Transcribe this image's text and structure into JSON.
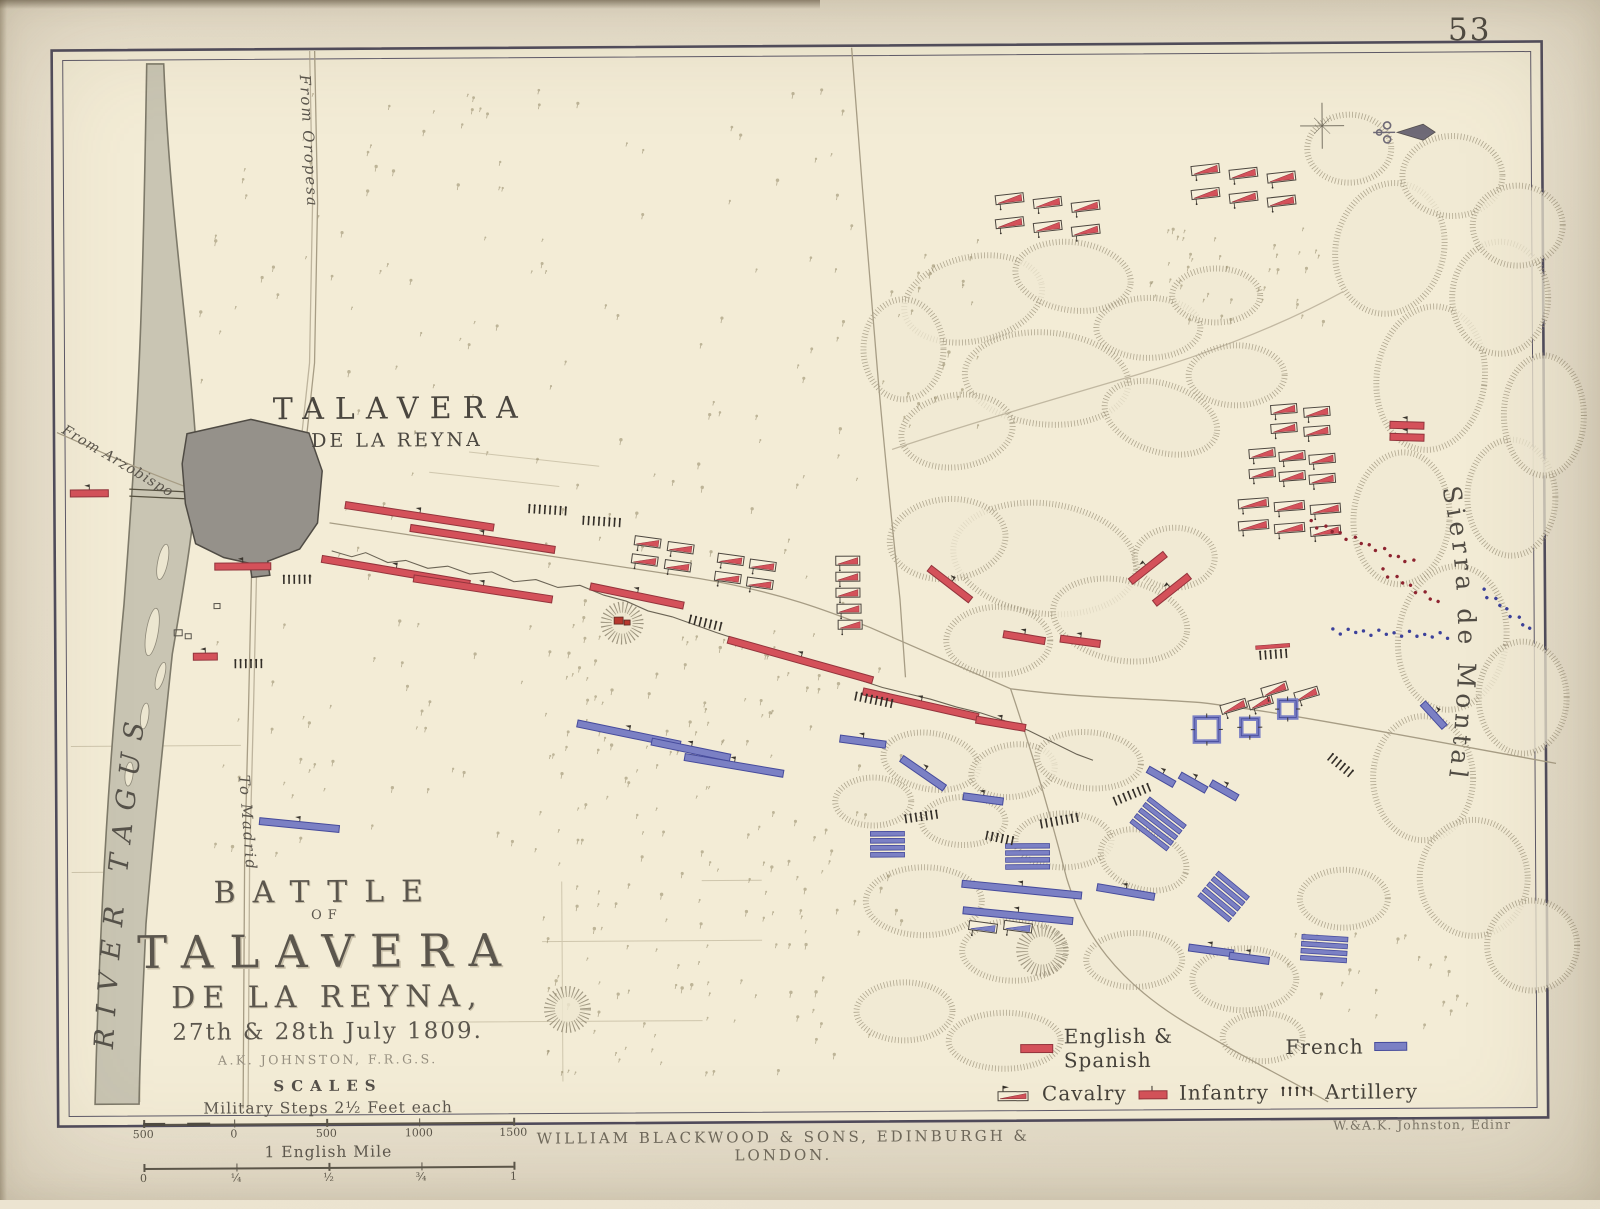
{
  "page": {
    "number": "53",
    "imprint": "WILLIAM BLACKWOOD & SONS, EDINBURGH & LONDON.",
    "engraver": "W.&A.K. Johnston, Edinr"
  },
  "title_block": {
    "line1": "BATTLE",
    "line2": "OF",
    "line3": "TALAVERA",
    "line4": "DE LA REYNA,",
    "line5": "27th & 28th July 1809.",
    "author": "A.K. JOHNSTON, F.R.G.S.",
    "scales_heading": "SCALES",
    "scale1_label": "Military Steps 2½ Feet each",
    "scale1_ticks": [
      "500",
      "0",
      "500",
      "1000",
      "1500"
    ],
    "scale2_label": "1 English Mile",
    "scale2_ticks": [
      "0",
      "¼",
      "½",
      "¾",
      "1"
    ]
  },
  "labels": {
    "town_line1": "TALAVERA",
    "town_line2": "DE LA REYNA",
    "river": "RIVER   TAGUS",
    "sierra": "Sierra de Montalban",
    "road_oropesa": "From Oropesa",
    "road_arzobispo": "From Arzobispo",
    "road_madrid": "To Madrid"
  },
  "legend": {
    "english": "English & Spanish",
    "french": "French",
    "cavalry": "Cavalry",
    "infantry": "Infantry",
    "artillery": "Artillery"
  },
  "colors": {
    "allied": "#d4515a",
    "allied_dark": "#93343c",
    "french": "#7b80c4",
    "french_dark": "#464b9c",
    "ink": "#332e28",
    "paper": "#f3ecd6",
    "frame": "#4f4b5c"
  },
  "units": [
    {
      "t": "inf",
      "s": "r",
      "x": 90,
      "y": 489,
      "w": 38,
      "a": 0
    },
    {
      "t": "inf",
      "s": "r",
      "x": 243,
      "y": 563,
      "w": 56,
      "a": 0
    },
    {
      "t": "inf",
      "s": "r",
      "x": 205,
      "y": 653,
      "w": 24,
      "a": 0
    },
    {
      "t": "inf",
      "s": "r",
      "x": 420,
      "y": 514,
      "w": 150,
      "a": 9
    },
    {
      "t": "inf",
      "s": "r",
      "x": 483,
      "y": 537,
      "w": 146,
      "a": 9
    },
    {
      "t": "inf",
      "s": "r",
      "x": 396,
      "y": 569,
      "w": 150,
      "a": 10
    },
    {
      "t": "inf",
      "s": "r",
      "x": 483,
      "y": 587,
      "w": 140,
      "a": 9
    },
    {
      "t": "inf",
      "s": "r",
      "x": 637,
      "y": 595,
      "w": 95,
      "a": 12
    },
    {
      "t": "inf",
      "s": "r",
      "x": 800,
      "y": 660,
      "w": 150,
      "a": 16
    },
    {
      "t": "inf",
      "s": "r",
      "x": 920,
      "y": 705,
      "w": 118,
      "a": 13
    },
    {
      "t": "inf",
      "s": "r",
      "x": 1000,
      "y": 725,
      "w": 50,
      "a": 10
    },
    {
      "t": "inf",
      "s": "r",
      "x": 950,
      "y": 585,
      "w": 52,
      "a": 38
    },
    {
      "t": "inf",
      "s": "r",
      "x": 1024,
      "y": 639,
      "w": 42,
      "a": 10
    },
    {
      "t": "inf",
      "s": "r",
      "x": 1080,
      "y": 643,
      "w": 40,
      "a": 8
    },
    {
      "t": "inf",
      "s": "r",
      "x": 1148,
      "y": 570,
      "w": 44,
      "a": -38
    },
    {
      "t": "inf",
      "s": "r",
      "x": 1172,
      "y": 592,
      "w": 44,
      "a": -38
    },
    {
      "t": "inf",
      "s": "r",
      "x": 1408,
      "y": 429,
      "w": 34,
      "a": 2
    },
    {
      "t": "inf",
      "s": "r",
      "x": 1408,
      "y": 441,
      "w": 34,
      "a": 2
    },
    {
      "t": "art",
      "s": "r",
      "x": 297,
      "y": 577,
      "n": 6,
      "a": 0
    },
    {
      "t": "art",
      "s": "r",
      "x": 248,
      "y": 661,
      "n": 6,
      "a": 0
    },
    {
      "t": "art",
      "s": "r",
      "x": 705,
      "y": 623,
      "n": 7,
      "a": 14
    },
    {
      "t": "art",
      "s": "r",
      "x": 873,
      "y": 701,
      "n": 8,
      "a": 12
    },
    {
      "t": "art",
      "s": "r",
      "x": 1273,
      "y": 658,
      "n": 6,
      "a": -4,
      "bar": true
    },
    {
      "t": "art",
      "s": "k",
      "x": 548,
      "y": 509,
      "n": 8,
      "a": 4
    },
    {
      "t": "art",
      "s": "k",
      "x": 602,
      "y": 521,
      "n": 8,
      "a": 4
    },
    {
      "t": "cav",
      "s": "r",
      "x": 648,
      "y": 541,
      "w": 26,
      "a": 8
    },
    {
      "t": "cav",
      "s": "r",
      "x": 681,
      "y": 547,
      "w": 26,
      "a": 8
    },
    {
      "t": "cav",
      "s": "r",
      "x": 645,
      "y": 559,
      "w": 26,
      "a": 8
    },
    {
      "t": "cav",
      "s": "r",
      "x": 678,
      "y": 565,
      "w": 26,
      "a": 8
    },
    {
      "t": "cav",
      "s": "r",
      "x": 731,
      "y": 559,
      "w": 26,
      "a": 8
    },
    {
      "t": "cav",
      "s": "r",
      "x": 763,
      "y": 565,
      "w": 26,
      "a": 8
    },
    {
      "t": "cav",
      "s": "r",
      "x": 728,
      "y": 577,
      "w": 26,
      "a": 8
    },
    {
      "t": "cav",
      "s": "r",
      "x": 760,
      "y": 583,
      "w": 26,
      "a": 8
    },
    {
      "t": "cav",
      "s": "r",
      "x": 848,
      "y": 561,
      "w": 24,
      "a": 0
    },
    {
      "t": "cav",
      "s": "r",
      "x": 848,
      "y": 577,
      "w": 24,
      "a": 0
    },
    {
      "t": "cav",
      "s": "r",
      "x": 848,
      "y": 593,
      "w": 24,
      "a": 0
    },
    {
      "t": "cav",
      "s": "r",
      "x": 849,
      "y": 609,
      "w": 24,
      "a": 0
    },
    {
      "t": "cav",
      "s": "r",
      "x": 850,
      "y": 625,
      "w": 24,
      "a": 0
    },
    {
      "t": "cav",
      "s": "r",
      "x": 1012,
      "y": 200,
      "w": 28,
      "a": -6
    },
    {
      "t": "cav",
      "s": "r",
      "x": 1050,
      "y": 204,
      "w": 28,
      "a": -6
    },
    {
      "t": "cav",
      "s": "r",
      "x": 1088,
      "y": 208,
      "w": 28,
      "a": -6
    },
    {
      "t": "cav",
      "s": "r",
      "x": 1012,
      "y": 224,
      "w": 28,
      "a": -6
    },
    {
      "t": "cav",
      "s": "r",
      "x": 1050,
      "y": 228,
      "w": 28,
      "a": -6
    },
    {
      "t": "cav",
      "s": "r",
      "x": 1088,
      "y": 232,
      "w": 28,
      "a": -6
    },
    {
      "t": "cav",
      "s": "r",
      "x": 1208,
      "y": 172,
      "w": 28,
      "a": -6
    },
    {
      "t": "cav",
      "s": "r",
      "x": 1246,
      "y": 176,
      "w": 28,
      "a": -6
    },
    {
      "t": "cav",
      "s": "r",
      "x": 1284,
      "y": 180,
      "w": 28,
      "a": -6
    },
    {
      "t": "cav",
      "s": "r",
      "x": 1208,
      "y": 196,
      "w": 28,
      "a": -6
    },
    {
      "t": "cav",
      "s": "r",
      "x": 1246,
      "y": 200,
      "w": 28,
      "a": -6
    },
    {
      "t": "cav",
      "s": "r",
      "x": 1284,
      "y": 204,
      "w": 28,
      "a": -6
    },
    {
      "t": "cav",
      "s": "r",
      "x": 1285,
      "y": 412,
      "w": 26,
      "a": -4
    },
    {
      "t": "cav",
      "s": "r",
      "x": 1318,
      "y": 415,
      "w": 26,
      "a": -4
    },
    {
      "t": "cav",
      "s": "r",
      "x": 1285,
      "y": 431,
      "w": 26,
      "a": -4
    },
    {
      "t": "cav",
      "s": "r",
      "x": 1318,
      "y": 434,
      "w": 26,
      "a": -4
    },
    {
      "t": "cav",
      "s": "r",
      "x": 1263,
      "y": 456,
      "w": 26,
      "a": -4
    },
    {
      "t": "cav",
      "s": "r",
      "x": 1293,
      "y": 459,
      "w": 26,
      "a": -4
    },
    {
      "t": "cav",
      "s": "r",
      "x": 1323,
      "y": 462,
      "w": 26,
      "a": -4
    },
    {
      "t": "cav",
      "s": "r",
      "x": 1263,
      "y": 476,
      "w": 26,
      "a": -4
    },
    {
      "t": "cav",
      "s": "r",
      "x": 1293,
      "y": 479,
      "w": 26,
      "a": -4
    },
    {
      "t": "cav",
      "s": "r",
      "x": 1323,
      "y": 482,
      "w": 26,
      "a": -4
    },
    {
      "t": "cav",
      "s": "r",
      "x": 1254,
      "y": 506,
      "w": 30,
      "a": -4
    },
    {
      "t": "cav",
      "s": "r",
      "x": 1290,
      "y": 509,
      "w": 30,
      "a": -4
    },
    {
      "t": "cav",
      "s": "r",
      "x": 1326,
      "y": 512,
      "w": 30,
      "a": -4
    },
    {
      "t": "cav",
      "s": "r",
      "x": 1254,
      "y": 528,
      "w": 30,
      "a": -4
    },
    {
      "t": "cav",
      "s": "r",
      "x": 1290,
      "y": 531,
      "w": 30,
      "a": -4
    },
    {
      "t": "cav",
      "s": "r",
      "x": 1326,
      "y": 534,
      "w": 30,
      "a": -4
    },
    {
      "t": "cav",
      "s": "r",
      "x": 1233,
      "y": 709,
      "w": 26,
      "a": -16
    },
    {
      "t": "cav",
      "s": "r",
      "x": 1260,
      "y": 705,
      "w": 24,
      "a": -16
    },
    {
      "t": "cav",
      "s": "r",
      "x": 1274,
      "y": 692,
      "w": 26,
      "a": -16
    },
    {
      "t": "cav",
      "s": "r",
      "x": 1306,
      "y": 697,
      "w": 24,
      "a": -16
    },
    {
      "t": "inf",
      "s": "b",
      "x": 298,
      "y": 822,
      "w": 80,
      "a": 6
    },
    {
      "t": "inf",
      "s": "b",
      "x": 628,
      "y": 733,
      "w": 105,
      "a": 12
    },
    {
      "t": "inf",
      "s": "b",
      "x": 690,
      "y": 749,
      "w": 80,
      "a": 12
    },
    {
      "t": "inf",
      "s": "b",
      "x": 733,
      "y": 765,
      "w": 100,
      "a": 10
    },
    {
      "t": "inf",
      "s": "b",
      "x": 862,
      "y": 742,
      "w": 46,
      "a": 8
    },
    {
      "t": "inf",
      "s": "b",
      "x": 922,
      "y": 774,
      "w": 52,
      "a": 35
    },
    {
      "t": "inf",
      "s": "b",
      "x": 982,
      "y": 800,
      "w": 40,
      "a": 8
    },
    {
      "t": "col",
      "s": "b",
      "x": 886,
      "y": 846,
      "w": 34,
      "n": 4,
      "a": 0
    },
    {
      "t": "col",
      "s": "b",
      "x": 1026,
      "y": 859,
      "w": 44,
      "n": 4,
      "a": 0
    },
    {
      "t": "col",
      "s": "b",
      "x": 1156,
      "y": 827,
      "w": 46,
      "n": 5,
      "a": 38
    },
    {
      "t": "col",
      "s": "b",
      "x": 1221,
      "y": 900,
      "w": 40,
      "n": 5,
      "a": 40
    },
    {
      "t": "inf",
      "s": "b",
      "x": 1020,
      "y": 891,
      "w": 120,
      "a": 6
    },
    {
      "t": "inf",
      "s": "b",
      "x": 1124,
      "y": 894,
      "w": 58,
      "a": 10
    },
    {
      "t": "inf",
      "s": "b",
      "x": 1016,
      "y": 917,
      "w": 110,
      "a": 6
    },
    {
      "t": "cav",
      "s": "b",
      "x": 981,
      "y": 928,
      "w": 28,
      "a": 8
    },
    {
      "t": "cav",
      "s": "b",
      "x": 1016,
      "y": 928,
      "w": 28,
      "a": 8
    },
    {
      "t": "inf",
      "s": "b",
      "x": 1209,
      "y": 953,
      "w": 45,
      "a": 8
    },
    {
      "t": "inf",
      "s": "b",
      "x": 1247,
      "y": 961,
      "w": 40,
      "a": 8
    },
    {
      "t": "col",
      "s": "b",
      "x": 1322,
      "y": 953,
      "w": 46,
      "n": 4,
      "a": 4
    },
    {
      "t": "inf",
      "s": "b",
      "x": 1160,
      "y": 779,
      "w": 30,
      "a": 30
    },
    {
      "t": "inf",
      "s": "b",
      "x": 1192,
      "y": 785,
      "w": 30,
      "a": 30
    },
    {
      "t": "inf",
      "s": "b",
      "x": 1223,
      "y": 793,
      "w": 30,
      "a": 30
    },
    {
      "t": "inf",
      "s": "b",
      "x": 1433,
      "y": 719,
      "w": 32,
      "a": 48
    },
    {
      "t": "sq",
      "s": "b",
      "x": 1206,
      "y": 732,
      "w": 24
    },
    {
      "t": "sq",
      "s": "b",
      "x": 1249,
      "y": 730,
      "w": 17
    },
    {
      "t": "sq",
      "s": "b",
      "x": 1287,
      "y": 712,
      "w": 17
    },
    {
      "t": "art",
      "s": "k",
      "x": 920,
      "y": 818,
      "n": 7,
      "a": -8
    },
    {
      "t": "art",
      "s": "k",
      "x": 1058,
      "y": 823,
      "n": 8,
      "a": -10
    },
    {
      "t": "art",
      "s": "k",
      "x": 1131,
      "y": 797,
      "n": 8,
      "a": -22
    },
    {
      "t": "art",
      "s": "k",
      "x": 998,
      "y": 840,
      "n": 6,
      "a": 12
    },
    {
      "t": "art",
      "s": "k",
      "x": 1339,
      "y": 769,
      "n": 6,
      "a": 40
    },
    {
      "t": "dots",
      "s": "r",
      "x": 1362,
      "y": 546,
      "w": 110,
      "a": 22,
      "n": 15
    },
    {
      "t": "dots",
      "s": "r",
      "x": 1410,
      "y": 590,
      "w": 64,
      "a": 30,
      "n": 9
    },
    {
      "t": "dots",
      "s": "b",
      "x": 1390,
      "y": 637,
      "w": 115,
      "a": 3,
      "n": 16
    },
    {
      "t": "dots",
      "s": "b",
      "x": 1506,
      "y": 614,
      "w": 60,
      "a": 40,
      "n": 9
    }
  ]
}
